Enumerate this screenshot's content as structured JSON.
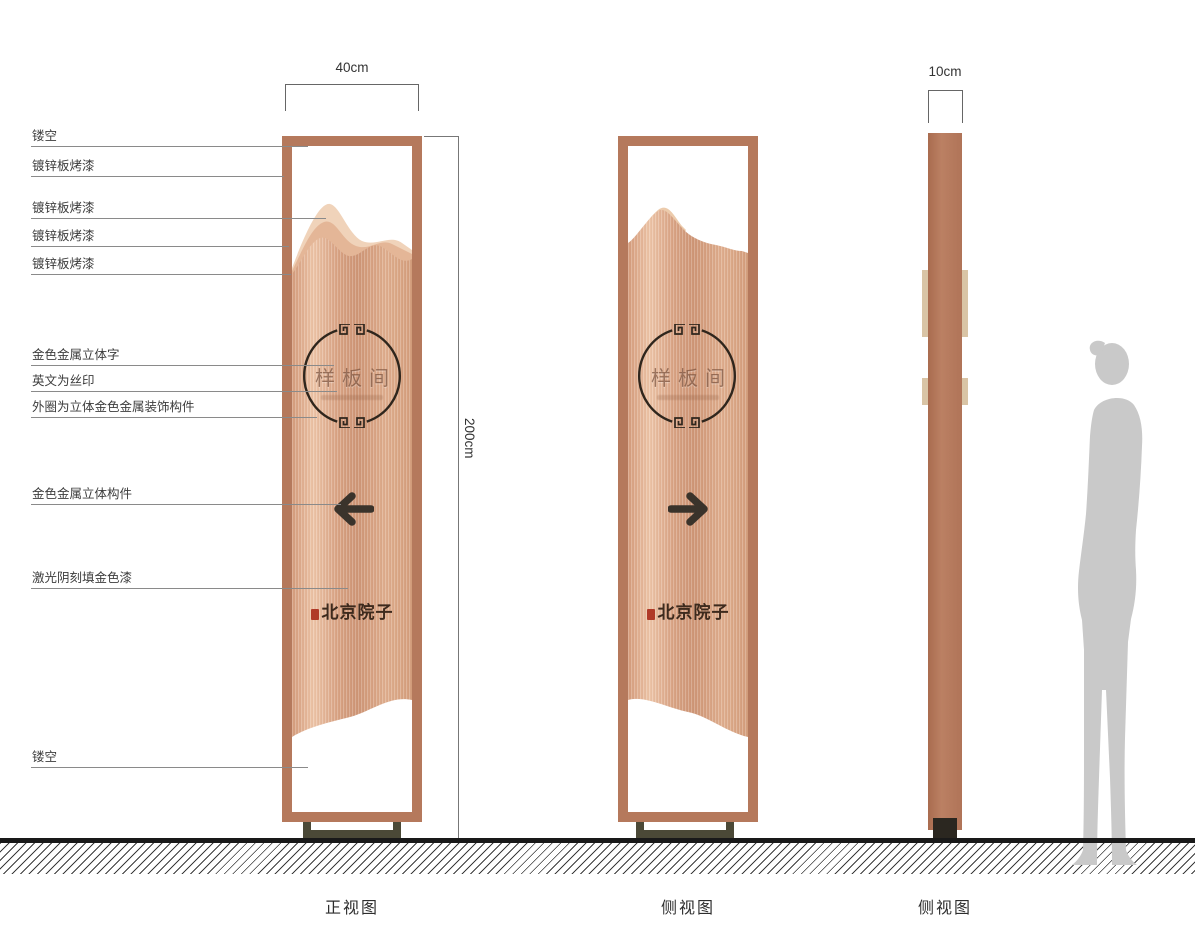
{
  "drawing": {
    "callouts": [
      "镂空",
      "镀锌板烤漆",
      "镀锌板烤漆",
      "镀锌板烤漆",
      "镀锌板烤漆",
      "金色金属立体字",
      "英文为丝印",
      "外圈为立体金色金属装饰构件",
      "金色金属立体构件",
      "激光阴刻填金色漆",
      "镂空"
    ],
    "dimensions": {
      "width": "40cm",
      "height": "200cm",
      "depth": "10cm"
    },
    "sign_content": {
      "room_name": "样板间",
      "brand_name": "北京院子",
      "front_arrow_direction": "left",
      "side_arrow_direction": "right"
    },
    "view_labels": {
      "front": "正视图",
      "middle": "侧视图",
      "right": "侧视图"
    },
    "colors": {
      "copper_frame": "#b5795c",
      "copper_light": "#f0d3ba",
      "copper_mid": "#cf9777",
      "base_olive": "#4b4937",
      "ink_dark": "#2f261d",
      "seal_red": "#b03a28",
      "silhouette_gray": "#c9c9c9"
    }
  }
}
